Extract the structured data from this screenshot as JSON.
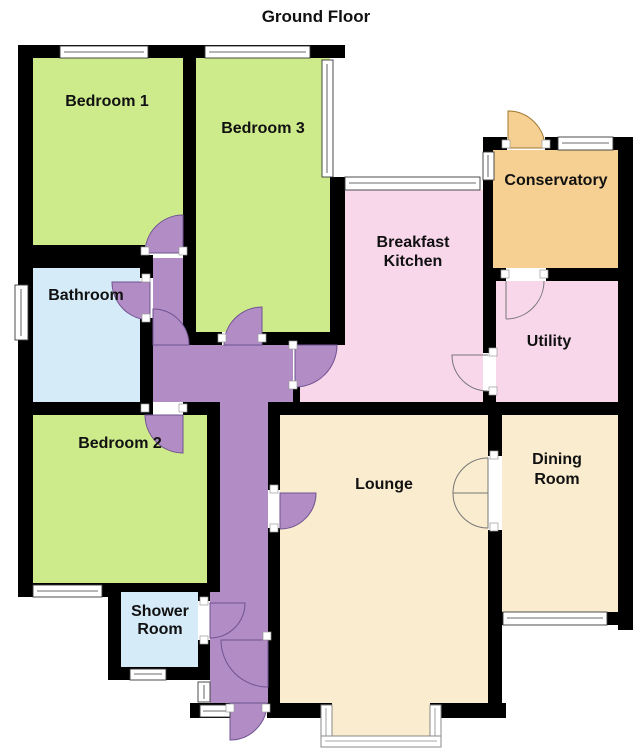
{
  "title": "Ground Floor",
  "colors": {
    "wall": "#000000",
    "bedroom": "#cdeb8b",
    "bath": "#d6ebf8",
    "kitchen_pink": "#f8d7eb",
    "hall": "#b28cc5",
    "lounge_cream": "#faeccf",
    "conservatory_tan": "#f6d092"
  },
  "rooms": {
    "bedroom1": {
      "label": "Bedroom 1"
    },
    "bedroom3": {
      "label": "Bedroom 3"
    },
    "bathroom": {
      "label": "Bathroom"
    },
    "bedroom2": {
      "label": "Bedroom 2"
    },
    "shower": {
      "line1": "Shower",
      "line2": "Room"
    },
    "kitchen": {
      "line1": "Breakfast",
      "line2": "Kitchen"
    },
    "conservatory": {
      "label": "Conservatory"
    },
    "utility": {
      "label": "Utility"
    },
    "lounge": {
      "label": "Lounge"
    },
    "dining": {
      "line1": "Dining",
      "line2": "Room"
    }
  }
}
